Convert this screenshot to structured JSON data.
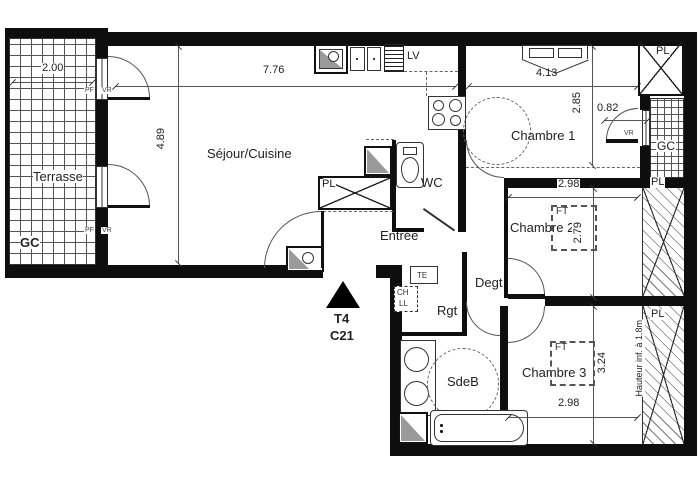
{
  "plan": {
    "unit": {
      "type": "T4",
      "number": "C21"
    },
    "rooms": {
      "terrasse": "Terrasse",
      "sejour_cuisine": "Séjour/Cuisine",
      "chambre1": "Chambre 1",
      "chambre2": "Chambre 2",
      "chambre3": "Chambre 3",
      "wc": "WC",
      "entree": "Entrée",
      "degagement": "Degt",
      "rangement": "Rgt",
      "salle_de_bains": "SdeB"
    },
    "annotations": {
      "pl": "PL",
      "gc": "GC",
      "lv": "LV",
      "ft": "FT",
      "pf": "PF",
      "vr": "VR",
      "te": "TE",
      "ch": "CH",
      "ll": "LL",
      "hauteur_note": "Hauteur inf. à 1.8m"
    },
    "dimensions": {
      "terrasse_width": "2.00",
      "sejour_width": "7.76",
      "sejour_depth": "4.89",
      "chambre1_width": "4.13",
      "chambre1_depth": "2.85",
      "balcon_width": "0.82",
      "chambre2_width": "2.98",
      "chambre2_depth": "2.79",
      "chambre3_depth": "3.24",
      "chambre3_width": "2.98"
    }
  }
}
